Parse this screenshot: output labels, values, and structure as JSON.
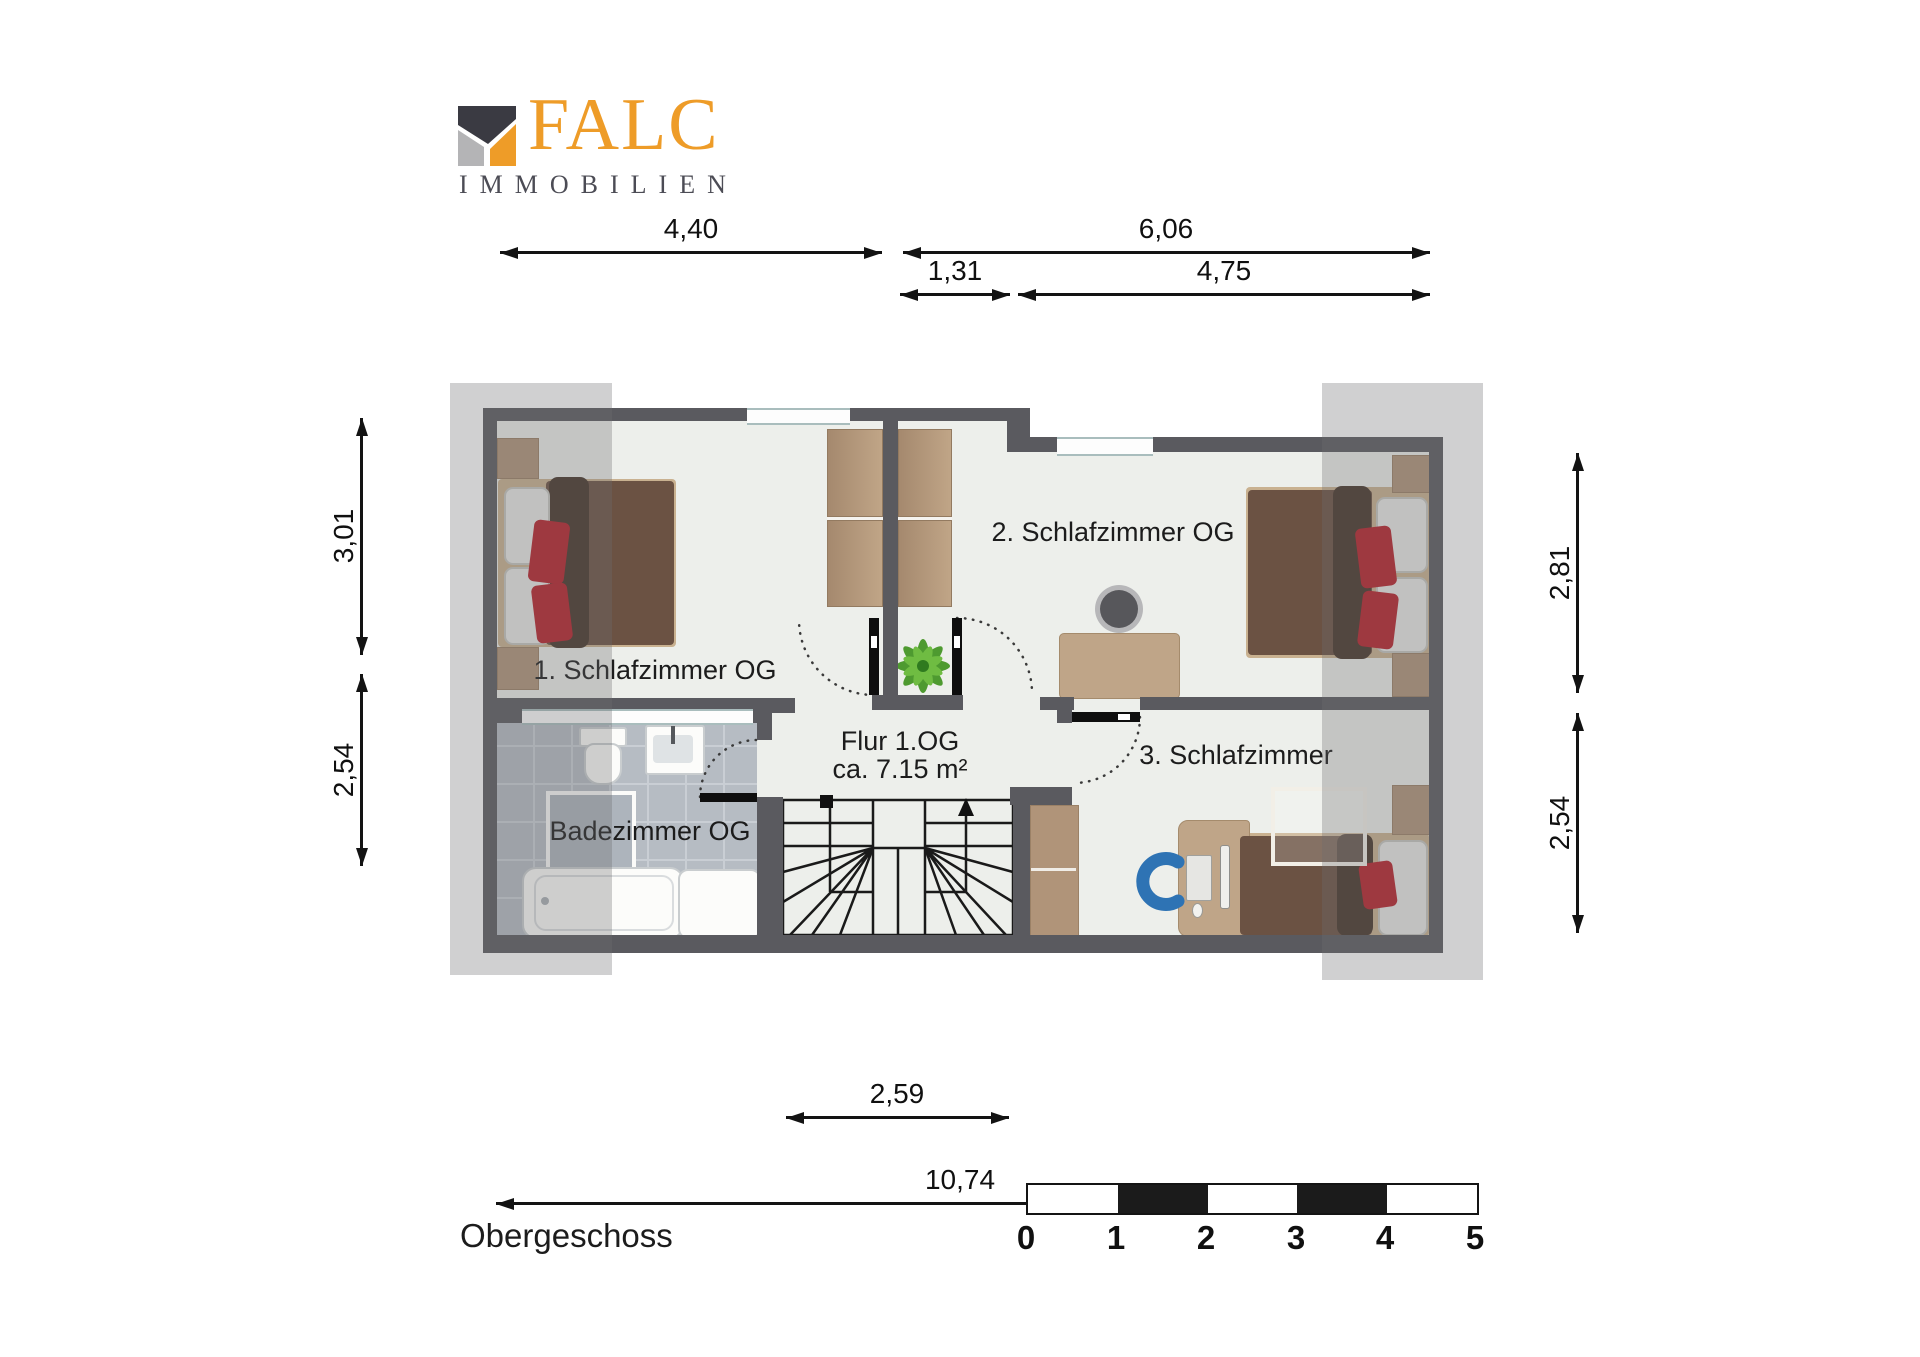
{
  "logo": {
    "name": "FALC",
    "subtitle": "IMMOBILIEN"
  },
  "floor_label": "Obergeschoss",
  "rooms": {
    "bedroom1": "1. Schlafzimmer OG",
    "bedroom2": "2. Schlafzimmer OG",
    "bedroom3": "3. Schlafzimmer",
    "hall_line1": "Flur 1.OG",
    "hall_line2": "ca. 7.15 m²",
    "bathroom": "Badezimmer OG"
  },
  "dimensions": {
    "top_width_left": "4,40",
    "top_width_right": "6,06",
    "top_inner_left": "1,31",
    "top_inner_right": "4,75",
    "left_upper": "3,01",
    "left_lower": "2,54",
    "right_upper": "2,81",
    "right_lower": "2,54",
    "bottom_stair": "2,59",
    "bottom_total": "10,74"
  },
  "scale_bar": {
    "labels": [
      "0",
      "1",
      "2",
      "3",
      "4",
      "5"
    ]
  },
  "colors": {
    "accent_orange": "#ee9c28",
    "logo_dark": "#3a3a42",
    "wall": "#5a5a5f",
    "floor": "#edefeb",
    "tile": "#b6bcc3",
    "wood": "#b09479",
    "duvet_brown": "#6b5243",
    "pillow_red": "#b5212a",
    "chair_blue": "#2e73b4",
    "roof_band": "#cbcbcb"
  }
}
